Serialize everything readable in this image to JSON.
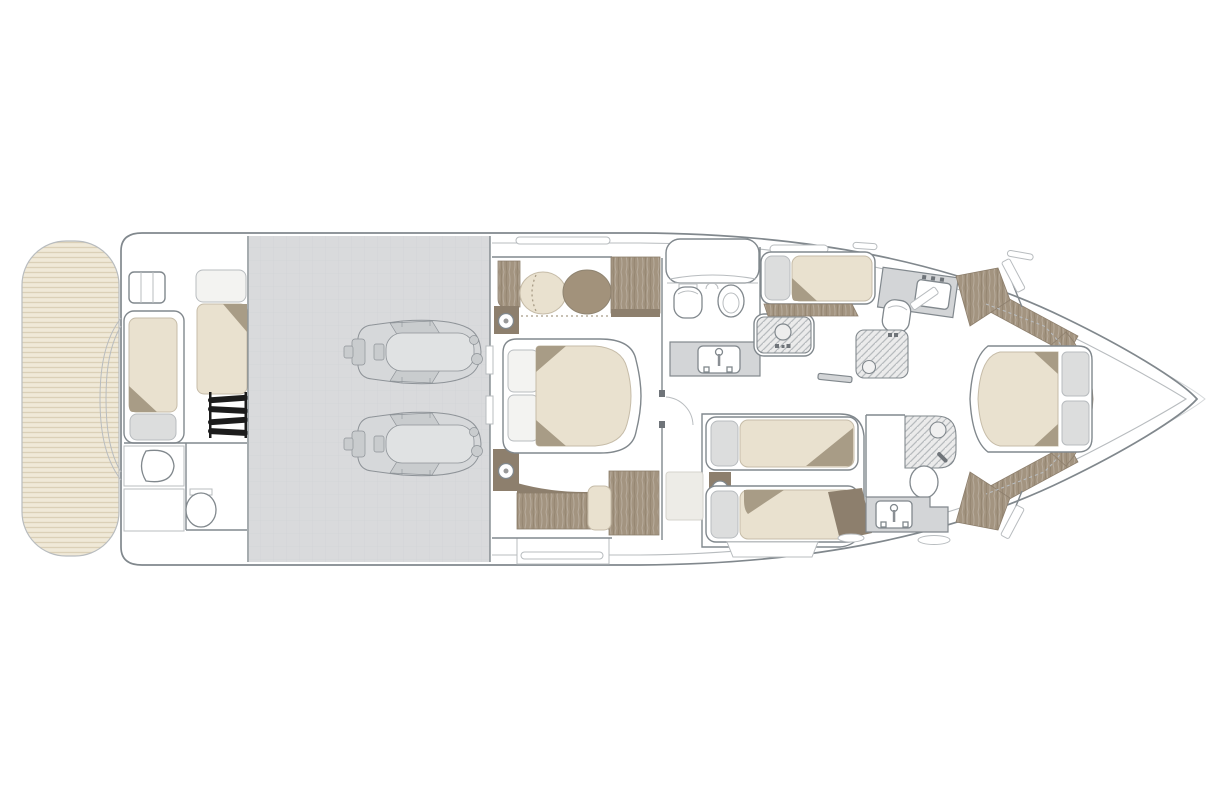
{
  "plan": {
    "vessel_view": "yacht-lower-deck-top-view",
    "orientation": {
      "bow": "right",
      "stern": "left"
    },
    "areas": [
      {
        "id": "swim-platform",
        "features": [
          "teak-decking"
        ]
      },
      {
        "id": "crew-cabin",
        "features": [
          "berth-port",
          "berth-starboard",
          "access-ladder",
          "washbasin",
          "toilet",
          "deck-hatch"
        ]
      },
      {
        "id": "engine-room",
        "features": [
          "engine-starboard",
          "engine-port"
        ]
      },
      {
        "id": "vip-cabin-midship",
        "features": [
          "double-bed",
          "pillows",
          "pouf-light",
          "pouf-dark",
          "wardrobe",
          "bedside-lamp-fwd",
          "bedside-lamp-aft",
          "bench-sofa",
          "side-cabinet"
        ]
      },
      {
        "id": "day-head",
        "features": [
          "stair-cabinet",
          "toilet",
          "bidet",
          "vanity-sink"
        ]
      },
      {
        "id": "utility-counter",
        "features": [
          "round-sink",
          "faucet"
        ]
      },
      {
        "id": "single-cabin-starboard",
        "features": [
          "single-berth",
          "pillow",
          "shelf"
        ]
      },
      {
        "id": "bathroom-starboard",
        "features": [
          "vanity-sink",
          "toilet",
          "shower"
        ]
      },
      {
        "id": "twin-cabin-port",
        "features": [
          "single-bed-fwd",
          "single-bed-aft",
          "nightstand-lamp",
          "step"
        ]
      },
      {
        "id": "bathroom-port",
        "features": [
          "shower",
          "toilet",
          "vanity-sink"
        ]
      },
      {
        "id": "bow-cabin",
        "features": [
          "double-bed",
          "bedside-panels",
          "wardrobe-upper",
          "wardrobe-lower",
          "doors",
          "wood-floor-chevron"
        ]
      }
    ]
  },
  "palette": {
    "paper": "#ffffff",
    "line-strong": "#81888d",
    "line-soft": "#b8bcbf",
    "line-faint": "#d5d8da",
    "teak-bg": "#f0e9d8",
    "teak-stripe": "#dbd0b7",
    "engine-floor": "#d9dadc",
    "engine-grid": "#cdcfd2",
    "engine-body": "#d6d8da",
    "engine-detail": "#c9ccce",
    "engine-line": "#8e9398",
    "wood": "#a39480",
    "wood-dark": "#8d7f6d",
    "mattress": "#e9e1cf",
    "mattress-edge": "#c6bca8",
    "fold": "#a89c86",
    "cushion": "#dcdddd",
    "pillow-white": "#f3f3f1",
    "counter": "#d3d5d7",
    "hatch-bg": "#ebebeb",
    "hatch-line": "#b7bbbe",
    "black": "#1c1c1c",
    "pale-step": "#edece7",
    "brown-pouf": "#a2927b"
  }
}
